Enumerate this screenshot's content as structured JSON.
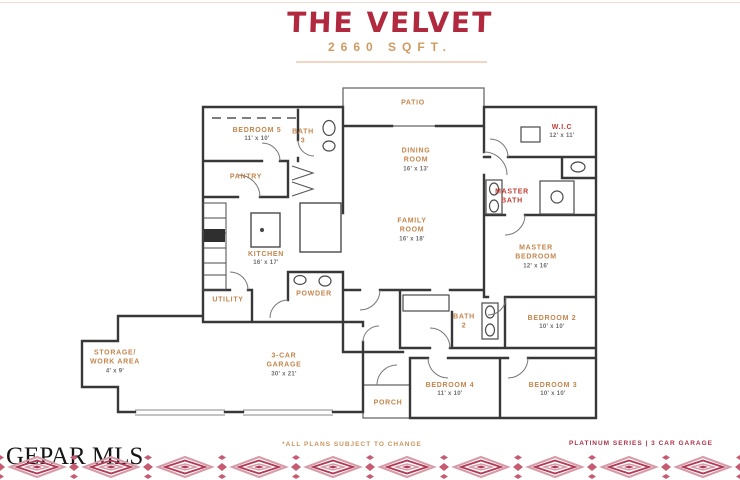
{
  "header": {
    "title": "THE VELVET",
    "subtitle": "2660 SQFT."
  },
  "rooms": [
    {
      "name": "PATIO",
      "dims": ""
    },
    {
      "name": "BEDROOM 5",
      "dims": "11' x 10'"
    },
    {
      "name": "BATH 3",
      "dims": ""
    },
    {
      "name": "PANTRY",
      "dims": ""
    },
    {
      "name": "DINING ROOM",
      "dims": "16' x 13'"
    },
    {
      "name": "W.I.C",
      "dims": "12' x 11'"
    },
    {
      "name": "MASTER BATH",
      "dims": ""
    },
    {
      "name": "FAMILY ROOM",
      "dims": "16' x 18'"
    },
    {
      "name": "KITCHEN",
      "dims": "16' x 17'"
    },
    {
      "name": "MASTER BEDROOM",
      "dims": "12' x 16'"
    },
    {
      "name": "UTILITY",
      "dims": ""
    },
    {
      "name": "POWDER",
      "dims": ""
    },
    {
      "name": "BATH 2",
      "dims": ""
    },
    {
      "name": "BEDROOM 2",
      "dims": "10' x 10'"
    },
    {
      "name": "STORAGE/ WORK AREA",
      "dims": "4' x 9'"
    },
    {
      "name": "3-CAR GARAGE",
      "dims": "30' x 21'"
    },
    {
      "name": "PORCH",
      "dims": ""
    },
    {
      "name": "BEDROOM 4",
      "dims": "11' x 10'"
    },
    {
      "name": "BEDROOM 3",
      "dims": "10' x 10'"
    }
  ],
  "footer": {
    "disclaimer": "*ALL PLANS SUBJECT TO CHANGE",
    "series": "PLATINUM SERIES | 3 CAR GARAGE"
  },
  "watermark": "GEPAR MLS",
  "colors": {
    "title_red": "#b1293f",
    "label_orange": "#c3854c",
    "label_red": "#c13b33",
    "dimension_gray": "#6d6d6d",
    "footer_orange": "#c9945f",
    "footer_red": "#a93348",
    "border_crimson": "#b03a55",
    "border_pink": "#d79aa8",
    "wall_dark": "#383838"
  }
}
